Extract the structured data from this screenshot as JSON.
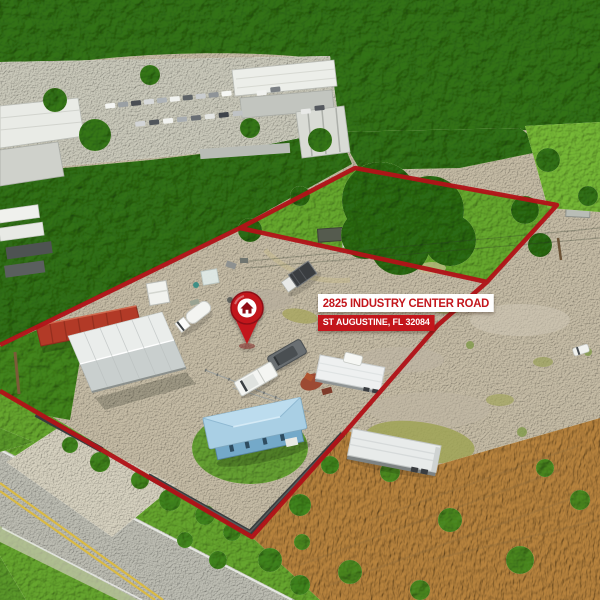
{
  "banner": {
    "address_line1": "2825 INDUSTRY CENTER ROAD",
    "address_line2": "ST AUGUSTINE, FL 32084"
  },
  "marker": {
    "icon": "location-pin-house-icon"
  },
  "colors": {
    "boundary_red": "#B11318",
    "banner_red": "#C3161C",
    "banner_white": "#FFFFFF",
    "pin_red": "#C2191F",
    "pin_dark_red": "#8E1014"
  },
  "scene": {
    "description": "Aerial drone photo: forested industrial area, red-outlined vacant back lot and front gravel lot with gray metal barn, red shipping container, trucks, white box trailers, blue-roofed house, road with double yellow lines at lower left"
  }
}
